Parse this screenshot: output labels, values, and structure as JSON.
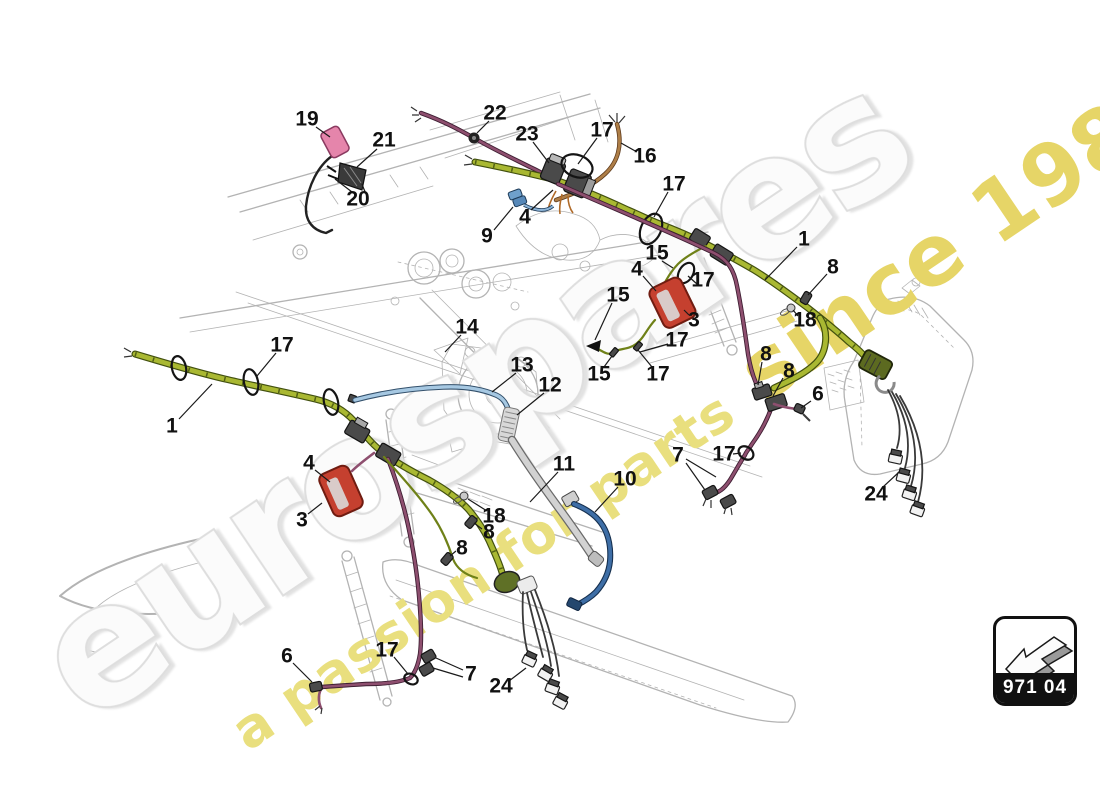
{
  "diagram": {
    "title_context": "wiring harness parts diagram",
    "watermark_brand": "eurospares",
    "watermark_tagline_part1": "a passion for parts",
    "watermark_tagline_part2": " since 1985",
    "part_code": "971 04",
    "arrow_icon": "3d-direction-arrow-lower-left",
    "colors": {
      "green": "#a9b832",
      "green-dark": "#42500f",
      "olive": "#6f8118",
      "purple": "#8e4f6f",
      "purple-dark": "#3f1f33",
      "blue": "#3e6ea6",
      "blue-dark": "#16304f",
      "lightblue": "#a6c8e2",
      "gray-wire": "#d2d2d2",
      "brown": "#ae7e47",
      "red": "#c5402f",
      "red-dark": "#701c11",
      "pink": "#e585ab",
      "drawing": "#b3b3b3",
      "wm-gray": "#dedede",
      "wm-fill": "#fbfbfb",
      "wm-yellow": "#e9df7e",
      "wm-yellow2": "#e6d567"
    },
    "callouts": [
      {
        "label": "19",
        "x": 307,
        "y": 119,
        "leaders": [
          [
            316,
            127,
            330,
            137
          ]
        ]
      },
      {
        "label": "21",
        "x": 384,
        "y": 140,
        "leaders": [
          [
            377,
            149,
            357,
            167
          ]
        ]
      },
      {
        "label": "20",
        "x": 358,
        "y": 199,
        "leaders": [
          [
            352,
            192,
            335,
            179
          ],
          [
            365,
            192,
            362,
            184
          ]
        ]
      },
      {
        "label": "22",
        "x": 495,
        "y": 113,
        "leaders": [
          [
            489,
            121,
            477,
            133
          ]
        ]
      },
      {
        "label": "23",
        "x": 527,
        "y": 134,
        "leaders": [
          [
            533,
            142,
            549,
            163
          ]
        ]
      },
      {
        "label": "17",
        "x": 602,
        "y": 130,
        "leaders": [
          [
            597,
            138,
            578,
            164
          ]
        ]
      },
      {
        "label": "16",
        "x": 645,
        "y": 156,
        "leaders": [
          [
            637,
            152,
            621,
            143
          ]
        ]
      },
      {
        "label": "4",
        "x": 525,
        "y": 217,
        "leaders": [
          [
            531,
            210,
            553,
            190
          ]
        ]
      },
      {
        "label": "9",
        "x": 487,
        "y": 236,
        "leaders": [
          [
            494,
            230,
            513,
            207
          ]
        ]
      },
      {
        "label": "17",
        "x": 674,
        "y": 184,
        "leaders": [
          [
            668,
            192,
            654,
            217
          ]
        ]
      },
      {
        "label": "15",
        "x": 657,
        "y": 253,
        "leaders": [
          [
            662,
            261,
            673,
            268
          ]
        ]
      },
      {
        "label": "1",
        "x": 804,
        "y": 239,
        "leaders": [
          [
            797,
            247,
            765,
            280
          ]
        ]
      },
      {
        "label": "4",
        "x": 637,
        "y": 269,
        "leaders": [
          [
            643,
            276,
            656,
            291
          ]
        ]
      },
      {
        "label": "8",
        "x": 833,
        "y": 267,
        "leaders": [
          [
            827,
            274,
            808,
            295
          ]
        ]
      },
      {
        "label": "15",
        "x": 618,
        "y": 295,
        "leaders": [
          [
            612,
            303,
            595,
            340
          ]
        ]
      },
      {
        "label": "3",
        "x": 694,
        "y": 320,
        "leaders": [
          [
            689,
            315,
            684,
            310
          ]
        ]
      },
      {
        "label": "17",
        "x": 703,
        "y": 280,
        "leaders": [
          [
            697,
            284,
            688,
            276
          ]
        ]
      },
      {
        "label": "18",
        "x": 805,
        "y": 320,
        "leaders": [
          [
            798,
            316,
            793,
            310
          ]
        ]
      },
      {
        "label": "17",
        "x": 677,
        "y": 340,
        "leaders": [
          [
            668,
            344,
            640,
            352
          ]
        ]
      },
      {
        "label": "15",
        "x": 599,
        "y": 374,
        "leaders": [
          [
            604,
            367,
            612,
            356
          ]
        ]
      },
      {
        "label": "17",
        "x": 658,
        "y": 374,
        "leaders": [
          [
            652,
            367,
            638,
            350
          ]
        ]
      },
      {
        "label": "8",
        "x": 766,
        "y": 354,
        "leaders": [
          [
            762,
            362,
            758,
            385
          ]
        ]
      },
      {
        "label": "8",
        "x": 789,
        "y": 371,
        "leaders": [
          [
            783,
            378,
            773,
            396
          ]
        ]
      },
      {
        "label": "6",
        "x": 818,
        "y": 394,
        "leaders": [
          [
            811,
            401,
            801,
            408
          ]
        ]
      },
      {
        "label": "14",
        "x": 467,
        "y": 327,
        "leaders": [
          [
            461,
            335,
            445,
            352
          ]
        ]
      },
      {
        "label": "17",
        "x": 282,
        "y": 345,
        "leaders": [
          [
            276,
            353,
            257,
            376
          ]
        ]
      },
      {
        "label": "13",
        "x": 522,
        "y": 365,
        "leaders": [
          [
            516,
            373,
            492,
            392
          ]
        ]
      },
      {
        "label": "12",
        "x": 550,
        "y": 385,
        "leaders": [
          [
            544,
            393,
            517,
            415
          ]
        ]
      },
      {
        "label": "1",
        "x": 172,
        "y": 426,
        "leaders": [
          [
            179,
            419,
            212,
            384
          ]
        ]
      },
      {
        "label": "11",
        "x": 564,
        "y": 464,
        "leaders": [
          [
            558,
            472,
            530,
            502
          ]
        ]
      },
      {
        "label": "10",
        "x": 625,
        "y": 479,
        "leaders": [
          [
            618,
            487,
            595,
            512
          ]
        ]
      },
      {
        "label": "4",
        "x": 309,
        "y": 463,
        "leaders": [
          [
            315,
            470,
            330,
            482
          ]
        ]
      },
      {
        "label": "3",
        "x": 302,
        "y": 520,
        "leaders": [
          [
            308,
            514,
            322,
            503
          ]
        ]
      },
      {
        "label": "18",
        "x": 494,
        "y": 516,
        "leaders": [
          [
            487,
            511,
            468,
            499
          ]
        ]
      },
      {
        "label": "8",
        "x": 489,
        "y": 532,
        "leaders": [
          [
            482,
            529,
            474,
            523
          ]
        ]
      },
      {
        "label": "8",
        "x": 462,
        "y": 548,
        "leaders": [
          [
            456,
            551,
            450,
            556
          ]
        ]
      },
      {
        "label": "7",
        "x": 678,
        "y": 455,
        "leaders": [
          [
            686,
            459,
            716,
            477
          ],
          [
            686,
            463,
            705,
            490
          ]
        ]
      },
      {
        "label": "17",
        "x": 724,
        "y": 454,
        "leaders": [
          [
            733,
            454,
            741,
            453
          ]
        ]
      },
      {
        "label": "24",
        "x": 876,
        "y": 494,
        "leaders": [
          [
            883,
            487,
            898,
            473
          ]
        ]
      },
      {
        "label": "6",
        "x": 287,
        "y": 656,
        "leaders": [
          [
            293,
            663,
            312,
            682
          ]
        ]
      },
      {
        "label": "17",
        "x": 387,
        "y": 650,
        "leaders": [
          [
            394,
            657,
            408,
            674
          ]
        ]
      },
      {
        "label": "7",
        "x": 471,
        "y": 674,
        "leaders": [
          [
            463,
            670,
            436,
            658
          ],
          [
            463,
            677,
            433,
            668
          ]
        ]
      },
      {
        "label": "24",
        "x": 501,
        "y": 686,
        "leaders": [
          [
            509,
            681,
            526,
            668
          ]
        ]
      }
    ]
  }
}
